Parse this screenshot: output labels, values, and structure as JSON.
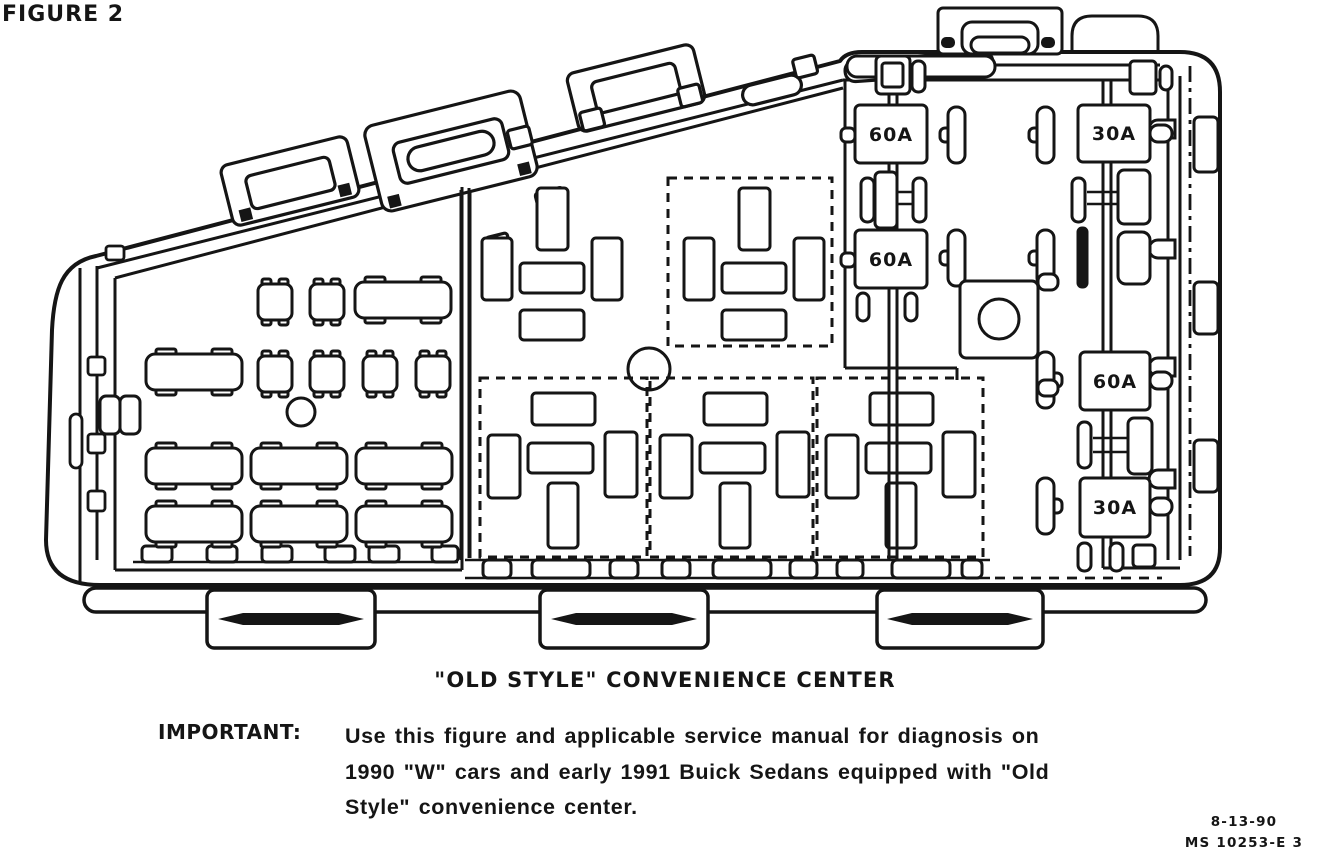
{
  "page": {
    "background": "#ffffff",
    "ink": "#151515"
  },
  "figure": {
    "label": "FIGURE 2"
  },
  "diagram": {
    "description": "Old Style convenience center fuse box line drawing",
    "fuses": [
      {
        "id": "maxi-fuse-60a-upper-left",
        "label": "60A"
      },
      {
        "id": "maxi-fuse-30a-upper-right",
        "label": "30A"
      },
      {
        "id": "maxi-fuse-60a-middle-left",
        "label": "60A"
      },
      {
        "id": "maxi-fuse-60a-middle-right",
        "label": "60A"
      },
      {
        "id": "maxi-fuse-30a-lower-right",
        "label": "30A"
      }
    ]
  },
  "caption": {
    "title": "\"OLD STYLE\" CONVENIENCE CENTER"
  },
  "note": {
    "label": "IMPORTANT:",
    "lines": [
      "Use this figure and applicable service manual for diagnosis on",
      "1990 \"W\" cars and early 1991 Buick Sedans equipped with \"Old",
      "Style\" convenience center."
    ]
  },
  "footer": {
    "date": "8-13-90",
    "doc_number": "MS 10253-E 3"
  }
}
